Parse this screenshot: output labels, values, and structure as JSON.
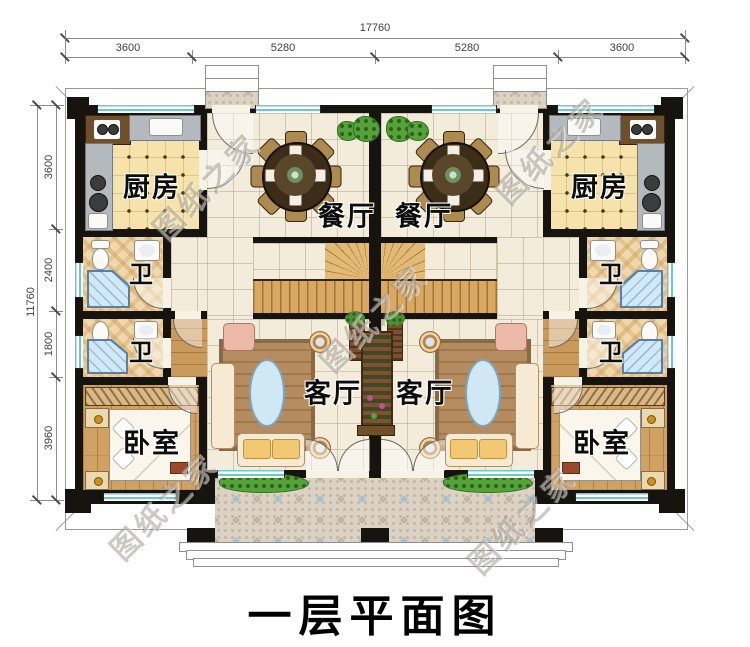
{
  "title": "一层平面图",
  "watermark_text": "图纸之家",
  "dimensions": {
    "top": {
      "total": "17760",
      "segments": [
        "3600",
        "5280",
        "5280",
        "3600"
      ]
    },
    "left": {
      "total": "11760",
      "segments": [
        "3600",
        "2400",
        "1800",
        "3960"
      ]
    }
  },
  "rooms": {
    "kitchen_left": "厨房",
    "kitchen_right": "厨房",
    "dining_left": "餐厅",
    "dining_right": "餐厅",
    "bath_upper_left": "卫",
    "bath_lower_left": "卫",
    "bath_upper_right": "卫",
    "bath_lower_right": "卫",
    "living_left": "客厅",
    "living_right": "客厅",
    "bedroom_left": "卧室",
    "bedroom_right": "卧室"
  },
  "colors": {
    "wall": "#17140f",
    "window": "#6fc6cf",
    "tile_floor": "#f4ecdb",
    "kitchen_floor": "#f6e3ab",
    "bath_floor": "#eed8ac",
    "wood_floor": "#cfa163",
    "patio_mosaic": "#dbd2c3",
    "stair_wood": "#d8a963",
    "plant_green": "#55a23b",
    "title_text": "#000000",
    "dimension_text": "#3f3f3f"
  }
}
